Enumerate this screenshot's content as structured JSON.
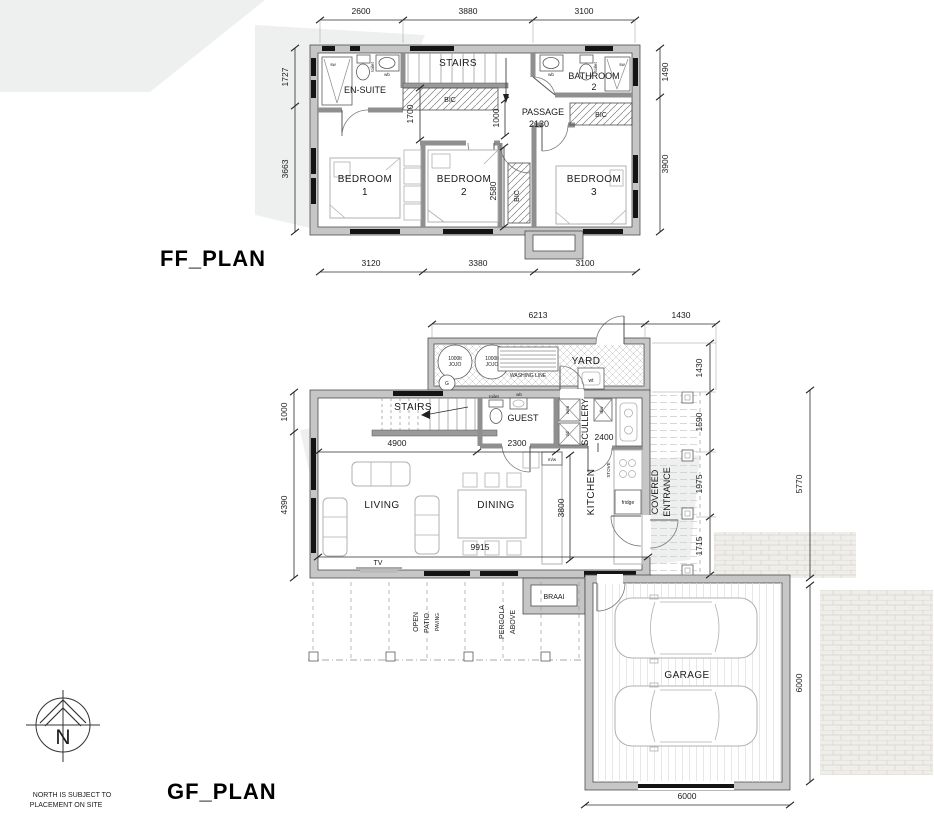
{
  "meta": {
    "ff_title": "FF_PLAN",
    "gf_title": "GF_PLAN",
    "north_letter": "N",
    "north_note_1": "NORTH IS SUBJECT TO",
    "north_note_2": "PLACEMENT ON SITE"
  },
  "colors": {
    "wall": "#c6c6c6",
    "line": "#4d4d4d",
    "window": "#141414",
    "paper": "#ffffff"
  },
  "ff": {
    "dims": {
      "top": [
        "2600",
        "3880",
        "3100"
      ],
      "bottom": [
        "3120",
        "3380",
        "3100"
      ],
      "left": [
        "1727",
        "3663"
      ],
      "right": [
        "1490",
        "3900"
      ],
      "bic": "1700",
      "passage_w": "1000",
      "passage_l": "2130",
      "bed2_depth": "2580"
    },
    "rooms": {
      "ensuite": "EN-SUITE",
      "stairs": "STAIRS",
      "bathroom": "BATHROOM",
      "bathroom_num": "2",
      "passage": "PASSAGE",
      "bedroom": "BEDROOM",
      "num1": "1",
      "num2": "2",
      "num3": "3",
      "bic": "BIC"
    },
    "fixtures": {
      "shower": "sw",
      "toilet": "toilet",
      "basin": "wb"
    }
  },
  "gf": {
    "dims": {
      "top": [
        "6213",
        "1430"
      ],
      "right_inner": [
        "1430",
        "1590",
        "1975",
        "1715"
      ],
      "entrance_total": "5770",
      "garage_right": "6000",
      "garage_bottom": "6000",
      "left": [
        "1000",
        "4390"
      ],
      "stairs": "4900",
      "guest": "2300",
      "scullery": "2400",
      "kitchen": "3800",
      "living": "9915"
    },
    "rooms": {
      "yard": "YARD",
      "washing_line": "WASHING LINE",
      "stairs": "STAIRS",
      "guest": "GUEST",
      "scullery": "SCULLERY",
      "kitchen": "KITCHEN",
      "living": "LIVING",
      "dining": "DINING",
      "covered_1": "COVERED",
      "covered_2": "ENTRANCE",
      "braai": "BRAAI",
      "patio_1": "OPEN",
      "patio_2": "PATIO.",
      "patio_3": "PAVING",
      "pergola_1": "PERGOLA",
      "pergola_2": "ABOVE",
      "garage": "GARAGE"
    },
    "fixtures": {
      "jojo_line1": "1000lt",
      "jojo_line2": "JOJO",
      "geyser": "G",
      "wash_trough": "wt",
      "toilet": "toilet",
      "basin": "wb",
      "washing_machine": "w/m",
      "tumble_dryer": "t/d",
      "dishwasher": "d/w",
      "microwave": "m/w",
      "stove": "STOVE",
      "fridge": "fridge",
      "tv": "TV"
    }
  }
}
